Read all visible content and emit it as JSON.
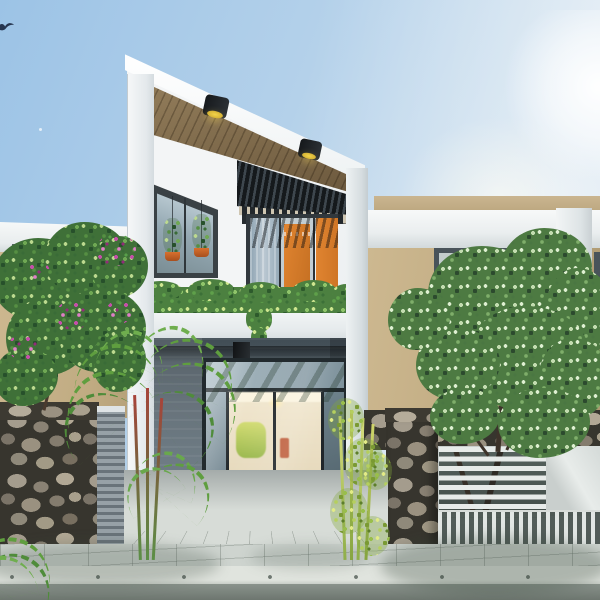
{
  "scene": {
    "type": "3d-architectural-exterior-render",
    "setting": "daytime street view of a narrow modern two-story townhouse between two neighboring houses",
    "sky": {
      "condition": "clear with bright sun glow upper right",
      "bird_count": 1
    },
    "main_house": {
      "facade_color_name": "white",
      "roof": "slanted white fascia descending left-to-right with wooden plank soffit",
      "soffit_downlights": 2,
      "second_floor": {
        "corner_window": "trapezoid window with two hanging plants in orange pots",
        "balcony": {
          "canopy": "black slatted pergola",
          "door": "dark-framed glass slider with blue-gray curtain and orange panels",
          "planter": "trailing green hedge along white parapet"
        }
      },
      "ground_floor": {
        "wall_color_name": "blue-gray",
        "entry_downlight": "black cube ceiling light",
        "door": "glass double door with transom and sidelights, warm lit interior with shelving and table"
      }
    },
    "neighbor_left": {
      "wall_color_name": "tan",
      "roof": "flat white slab",
      "windows": 2
    },
    "neighbor_right": {
      "wall_color_name": "tan",
      "roof": "flat white slab with tan parapet",
      "windows": 1,
      "column": "white"
    },
    "fence": {
      "left": "natural stone wall with gray slatted panel",
      "right": "stone pillars and band with white horizontal-slat gate and vertical picket base"
    },
    "vegetation": [
      "magenta flowering tree left",
      "red-stemmed palms at entry",
      "bamboo right of entry",
      "large leafy tree right"
    ],
    "street": [
      "paved sidewalk tiles",
      "light concrete curb",
      "asphalt road"
    ]
  },
  "palette": {
    "sky-top": "#9cc3e6",
    "sky-light": "#e7eff5",
    "house-white": "#f3f5f6",
    "house-shadow": "#d7dde2",
    "soffit-wood": "#96805d",
    "soffit-wood-dark": "#6a573c",
    "pergola-dark": "#24292e",
    "frame-dark": "#3a4145",
    "glass-blue": "#adbfca",
    "accent-orange": "#e08430",
    "curtain-blue": "#9db0bd",
    "neighbor-tan": "#c7b28b",
    "entry-gray": "#5f6e78",
    "entry-gray-dark": "#414d55",
    "interior-warm": "#f1e7cf",
    "stone-dark": "#37352e",
    "leaf-mid": "#58934a",
    "bamboo-bright": "#b5cf5e",
    "flower-magenta": "#c450a8",
    "pave-light": "#ced4cf",
    "curb-light": "#e0e4de",
    "road-gray": "#7b847e",
    "gate-white": "#e7ebe9",
    "slatwall-gray": "#7e8a91"
  }
}
